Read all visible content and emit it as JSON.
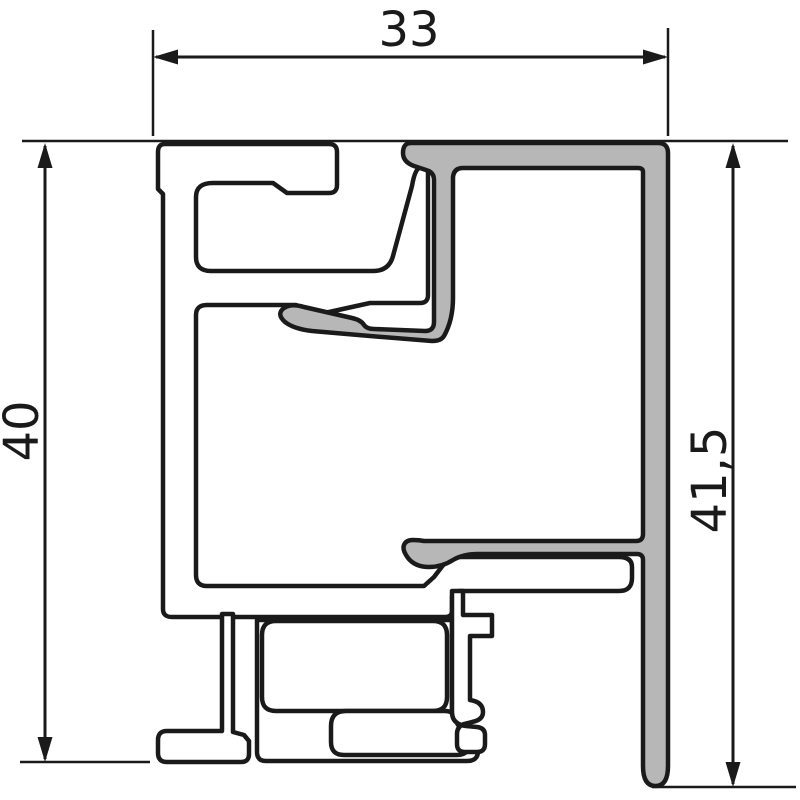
{
  "drawing": {
    "title": "aluminium profile cross-section",
    "dimensions": {
      "width_top": "33",
      "height_left": "40",
      "height_right": "41,5"
    }
  },
  "colors": {
    "background": "#ffffff",
    "outline": "#1a1a1a",
    "frame_fill": "#ffffff",
    "cover_fill": "#b7b7b7",
    "dim_line": "#1a1a1a"
  }
}
